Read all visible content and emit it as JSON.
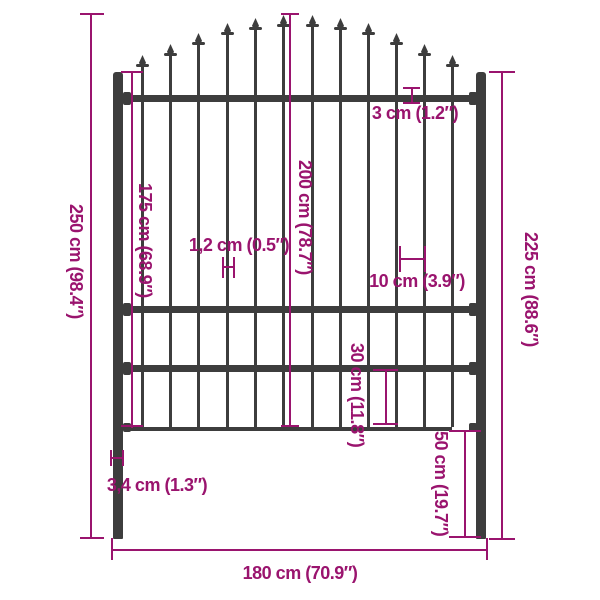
{
  "figure": {
    "type": "product-dimension-diagram",
    "subject": "fence panel with spear-top pickets and ground-spike posts",
    "colors": {
      "dimension": "#9A146E",
      "fence": "#3D3D3D",
      "background": "#FFFFFF"
    },
    "dimensions": {
      "total_height": "250 cm (98.4″)",
      "picket_height": "175 cm (68.9″)",
      "panel_height": "200 cm (78.7″)",
      "rail_thickness": "3 cm (1.2″)",
      "picket_thickness": "1,2 cm (0.5″)",
      "picket_spacing": "10 cm (3.9″)",
      "post_height": "225 cm (88.6″)",
      "bottom_section_height": "30 cm (11.8″)",
      "ground_spike_depth": "50 cm (19.7″)",
      "post_thickness": "3,4 cm (1.3″)",
      "total_width": "180 cm (70.9″)"
    }
  }
}
